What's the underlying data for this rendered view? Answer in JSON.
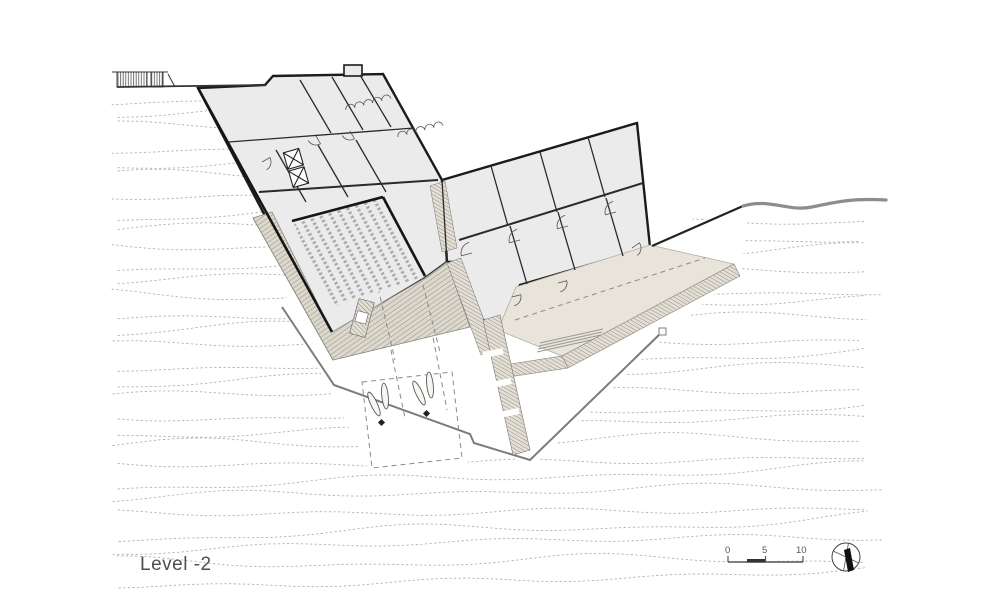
{
  "title": {
    "label": "Level -2"
  },
  "scale_bar": {
    "labels": [
      "0",
      "5",
      "10"
    ]
  },
  "north_arrow": {
    "name": "north-arrow"
  },
  "palette": {
    "background": "#ffffff",
    "contour_line": "#b2b2b2",
    "building_fill": "#ebebeb",
    "wall_dark": "#1b1b1b",
    "partition": "#2a2a2a",
    "thin_line": "#555555",
    "plaza_fill": "#dcd8cd",
    "plaza_hatch": "#95917f",
    "terrace_fill": "#e8e4da",
    "terrace_edge": "#b3afa5",
    "site_line_gray": "#8d8d8d",
    "label_gray": "#4f4f4f"
  }
}
